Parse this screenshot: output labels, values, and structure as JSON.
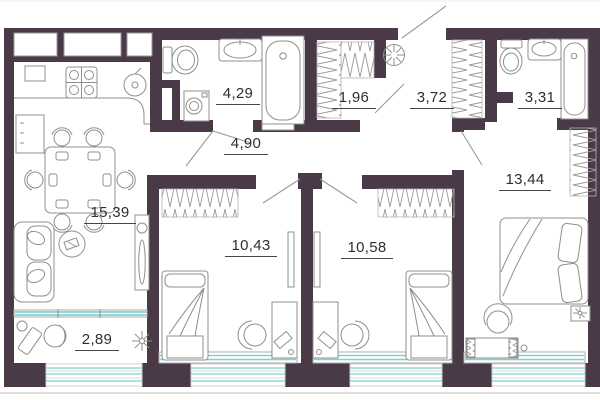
{
  "plan": {
    "rooms": {
      "kitchen_living": {
        "area": "15,39"
      },
      "bathroom_main": {
        "area": "4,29"
      },
      "storage": {
        "area": "1,96"
      },
      "hallway": {
        "area": "3,72"
      },
      "bathroom_second": {
        "area": "3,31"
      },
      "corridor": {
        "area": "4,90"
      },
      "bedroom_one": {
        "area": "10,43"
      },
      "bedroom_two": {
        "area": "10,58"
      },
      "bedroom_large": {
        "area": "13,44"
      },
      "balcony": {
        "area": "2,89"
      }
    },
    "colors": {
      "wall": "#4a3a48",
      "glazing": "#7fd2d0",
      "line": "#8f8f8f",
      "text": "#2e2e2e"
    }
  }
}
